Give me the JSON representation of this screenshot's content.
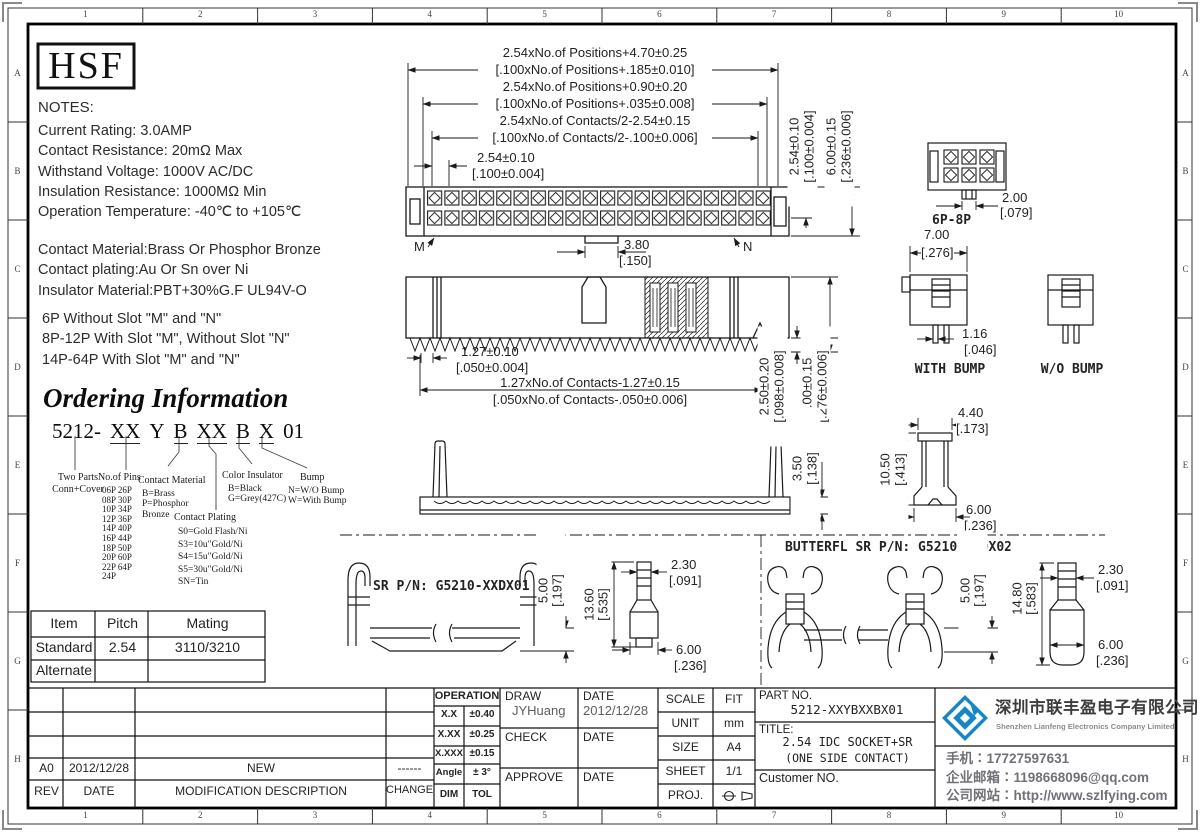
{
  "frame": {
    "zones_h": [
      "1",
      "2",
      "3",
      "4",
      "5",
      "6",
      "7",
      "8",
      "9",
      "10"
    ],
    "zones_v": [
      "A",
      "B",
      "C",
      "D",
      "E",
      "F",
      "G",
      "H"
    ]
  },
  "logo_text": "HSF",
  "notes": {
    "title": "NOTES:",
    "lines": [
      "Current Rating: 3.0AMP",
      "Contact Resistance: 20mΩ Max",
      "Withstand Voltage: 1000V AC/DC",
      "Insulation Resistance: 1000MΩ Min",
      "Operation Temperature: -40℃ to +105℃"
    ],
    "material": [
      "Contact Material:Brass Or Phosphor Bronze",
      "Contact plating:Au Or Sn over Ni",
      "Insulator Material:PBT+30%G.F UL94V-O"
    ],
    "slots": [
      "6P Without Slot \"M\" and \"N\"",
      "8P-12P With Slot \"M\", Without Slot \"N\"",
      "14P-64P With Slot \"M\" and \"N\""
    ]
  },
  "ordering": {
    "title": "Ordering Information",
    "code": [
      "5212-",
      "XX",
      "Y",
      "B",
      "XX",
      "B",
      "X",
      "01"
    ],
    "two_parts": {
      "l1": "Two Parts",
      "l2": "Conn+Cover"
    },
    "pins": {
      "title": "No.of Pins",
      "items": [
        "06P 26P",
        "08P 30P",
        "10P 34P",
        "12P 36P",
        "14P 40P",
        "16P 44P",
        "18P 50P",
        "20P 60P",
        "22P 64P",
        "24P"
      ]
    },
    "contact_material": {
      "title": "Contact Material",
      "items": [
        "B=Brass",
        "P=Phosphor",
        "Bronze"
      ]
    },
    "contact_plating": {
      "title": "Contact Plating",
      "items": [
        "S0=Gold Flash/Ni",
        "S3=10u\"Gold/Ni",
        "S4=15u\"Gold/Ni",
        "S5=30u\"Gold/Ni",
        "SN=Tin"
      ]
    },
    "color_insulator": {
      "title": "Color Insulator",
      "items": [
        "B=Black",
        "G=Grey(427C)"
      ]
    },
    "bump": {
      "title": "Bump",
      "items": [
        "N=W/O Bump",
        "W=With Bump"
      ]
    }
  },
  "item_table": {
    "headers": [
      "Item",
      "Pitch",
      "Mating"
    ],
    "row_standard": [
      "Standard",
      "2.54",
      "3110/3210"
    ],
    "row_alternate": [
      "Alternate",
      "",
      ""
    ]
  },
  "labels": {
    "m": "M",
    "n": "N",
    "p68": "6P-8P",
    "with_bump": "WITH BUMP",
    "wo_bump": "W/O BUMP",
    "sr_pn": "SR P/N: G5210-XXDX01",
    "butterfl_pn": "BUTTERFL SR P/N: G5210-XXDX02"
  },
  "dims": {
    "pos470": "2.54xNo.of Positions+4.70±0.25",
    "pos470i": "[.100xNo.of Positions+.185±0.010]",
    "pos090": "2.54xNo.of Positions+0.90±0.20",
    "pos090i": "[.100xNo.of Positions+.035±0.008]",
    "cont254": "2.54xNo.of Contacts/2-2.54±0.15",
    "cont254i": "[.100xNo.of Contacts/2-.100±0.006]",
    "p254": "2.54±0.10",
    "p254i": "[.100±0.004]",
    "h600": "6.00±0.15",
    "h600i": "[.236±0.006]",
    "d200": "2.00",
    "d200i": "[.079]",
    "d380": "3.80",
    "d380i": "[.150]",
    "t127": "1.27±0.10",
    "t127i": "[.050±0.004]",
    "c127": "1.27xNo.of Contacts-1.27±0.15",
    "c127i": "[.050xNo.of Contacts-.050±0.006]",
    "d250": "2.50±0.20",
    "d250i": "[.098±0.008]",
    "d700b": "7.00±0.15",
    "d700bi": "[.276±0.006]",
    "d700": "7.00",
    "d700i": "[.276]",
    "d116": "1.16",
    "d116i": "[.046]",
    "d440": "4.40",
    "d440i": "[.173]",
    "d1050": "10.50",
    "d1050i": "[.413]",
    "d350": "3.50",
    "d350i": "[.138]",
    "d500": "5.00",
    "d500i": "[.197]",
    "d1360": "13.60",
    "d1360i": "[.535]",
    "d1480": "14.80",
    "d1480i": "[.583]",
    "d230": "2.30",
    "d230i": "[.091]",
    "d600": "6.00",
    "d600i": "[.236]"
  },
  "title_block": {
    "revision": {
      "rev_h": "REV",
      "date_h": "DATE",
      "desc_h": "MODIFICATION  DESCRIPTION",
      "change_h": "CHANGE",
      "rev": "A0",
      "date": "2012/12/28",
      "desc": "NEW",
      "change": "------"
    },
    "tolerance": {
      "header": "OPERATION",
      "r1l": "X.X",
      "r1v": "±0.40",
      "r2l": "X.XX",
      "r2v": "±0.25",
      "r3l": "X.XXX",
      "r3v": "±0.15",
      "r4l": "Angle",
      "r4v": "± 3°",
      "r5l": "DIM",
      "r5v": "TOL"
    },
    "sign": {
      "draw_label": "DRAW",
      "draw_name": "JYHuang",
      "date_label1": "DATE",
      "draw_date": "2012/12/28",
      "check_label": "CHECK",
      "date_label2": "DATE",
      "approve_label": "APPROVE",
      "date_label3": "DATE"
    },
    "meta": {
      "scale_label": "SCALE",
      "scale": "FIT",
      "unit_label": "UNIT",
      "unit": "mm",
      "size_label": "SIZE",
      "size": "A4",
      "sheet_label": "SHEET",
      "sheet": "1/1",
      "proj_label": "PROJ."
    },
    "part": {
      "part_no_label": "PART NO.",
      "part_no": "5212-XXYBXXBX01",
      "title_label": "TITLE:",
      "title1": "2.54 IDC SOCKET+SR",
      "title2": "(ONE SIDE CONTACT)",
      "customer_label": "Customer  NO."
    }
  },
  "company": {
    "name_cn": "深圳市联丰盈电子有限公司",
    "name_en": "Shenzhen Lianfeng Electronics Company Limited",
    "phone": "手机∶17727597631",
    "email": "企业邮箱∶1198668096@qq.com",
    "website": "公司网站∶http://www.szlfying.com",
    "logo_blue": "#1686c6"
  }
}
